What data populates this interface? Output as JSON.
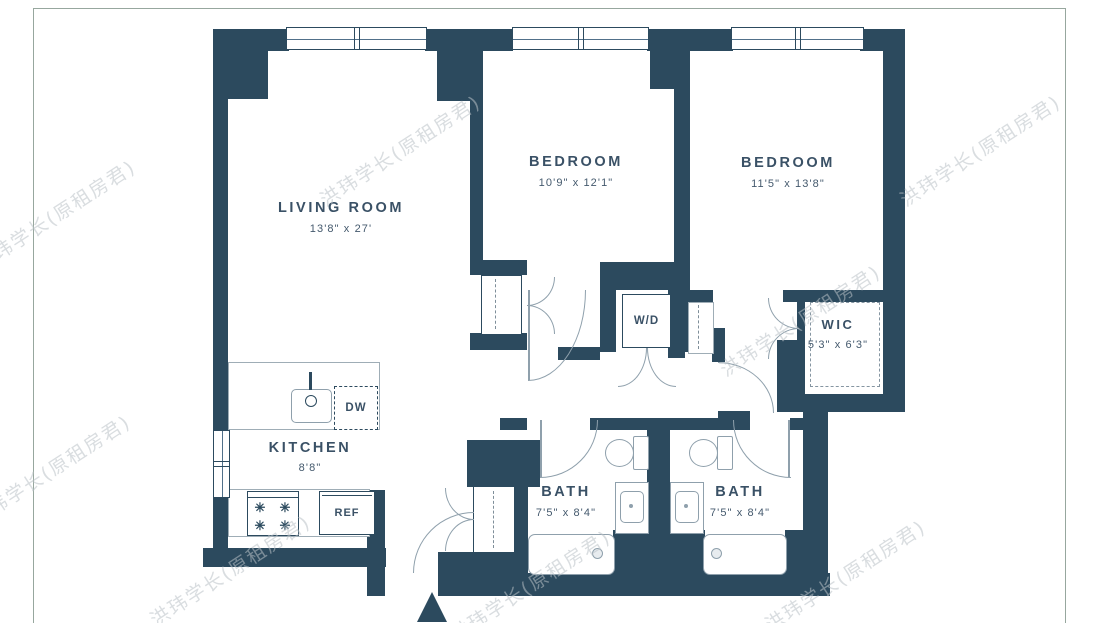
{
  "watermark": {
    "text": "洪玮学长(原租房君)"
  },
  "colors": {
    "wall": "#2c4a5e",
    "floor": "#ffffff",
    "fixture_line": "#8fa0ac",
    "label": "#3a5166",
    "frame_line": "#97a79e",
    "watermark": "#bac1c7"
  },
  "rooms": {
    "living_room": {
      "name": "LIVING ROOM",
      "dimensions": "13'8\" x 27'"
    },
    "bedroom_1": {
      "name": "BEDROOM",
      "dimensions": "10'9\" x 12'1\""
    },
    "bedroom_2": {
      "name": "BEDROOM",
      "dimensions": "11'5\" x 13'8\""
    },
    "kitchen": {
      "name": "KITCHEN",
      "dimensions": "8'8\""
    },
    "wic": {
      "name": "WIC",
      "dimensions": "5'3\" x 6'3\""
    },
    "bath_1": {
      "name": "BATH",
      "dimensions": "7'5\" x 8'4\""
    },
    "bath_2": {
      "name": "BATH",
      "dimensions": "7'5\" x 8'4\""
    }
  },
  "fixtures": {
    "washer_dryer": "W/D",
    "dishwasher": "DW",
    "refrigerator": "REF"
  },
  "icons": {
    "burner": "✳"
  }
}
